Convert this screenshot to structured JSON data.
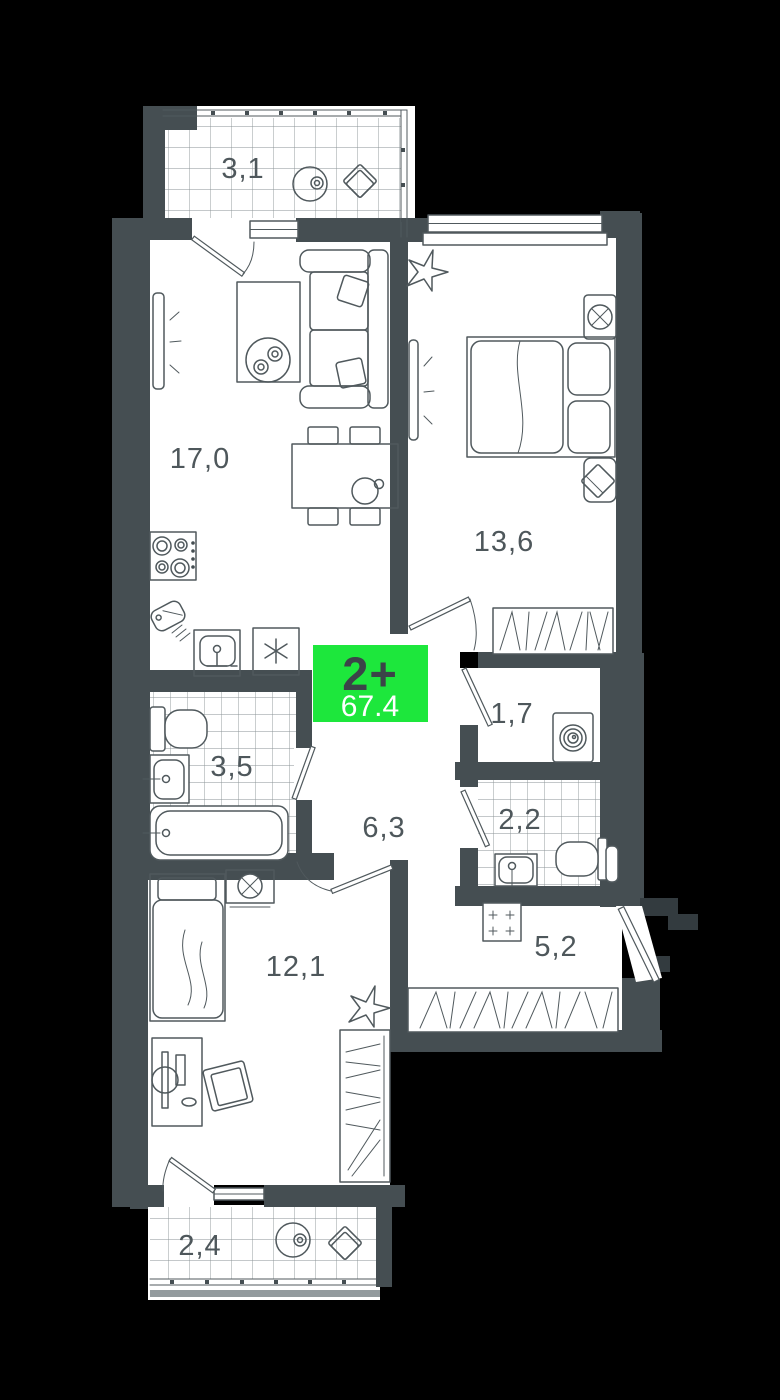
{
  "plan": {
    "badge": {
      "type": "2+",
      "area": "67.4"
    },
    "rooms": [
      {
        "name": "balcony-top",
        "area": "3,1"
      },
      {
        "name": "living-kitchen",
        "area": "17,0"
      },
      {
        "name": "bedroom-main",
        "area": "13,6"
      },
      {
        "name": "dressing-room",
        "area": "1,7"
      },
      {
        "name": "bathroom",
        "area": "3,5"
      },
      {
        "name": "hallway",
        "area": "6,3"
      },
      {
        "name": "wc",
        "area": "2,2"
      },
      {
        "name": "entry-corridor",
        "area": "5,2"
      },
      {
        "name": "bedroom-second",
        "area": "12,1"
      },
      {
        "name": "balcony-bottom",
        "area": "2,4"
      }
    ],
    "colors": {
      "background": "#000000",
      "walls": "#454e52",
      "floor": "#ffffff",
      "lines": "#50595d",
      "tile_grid": "#8a9295",
      "badge_background": "#1de73c",
      "badge_type_text": "#3b4448",
      "badge_area_text": "#ffffff"
    }
  }
}
